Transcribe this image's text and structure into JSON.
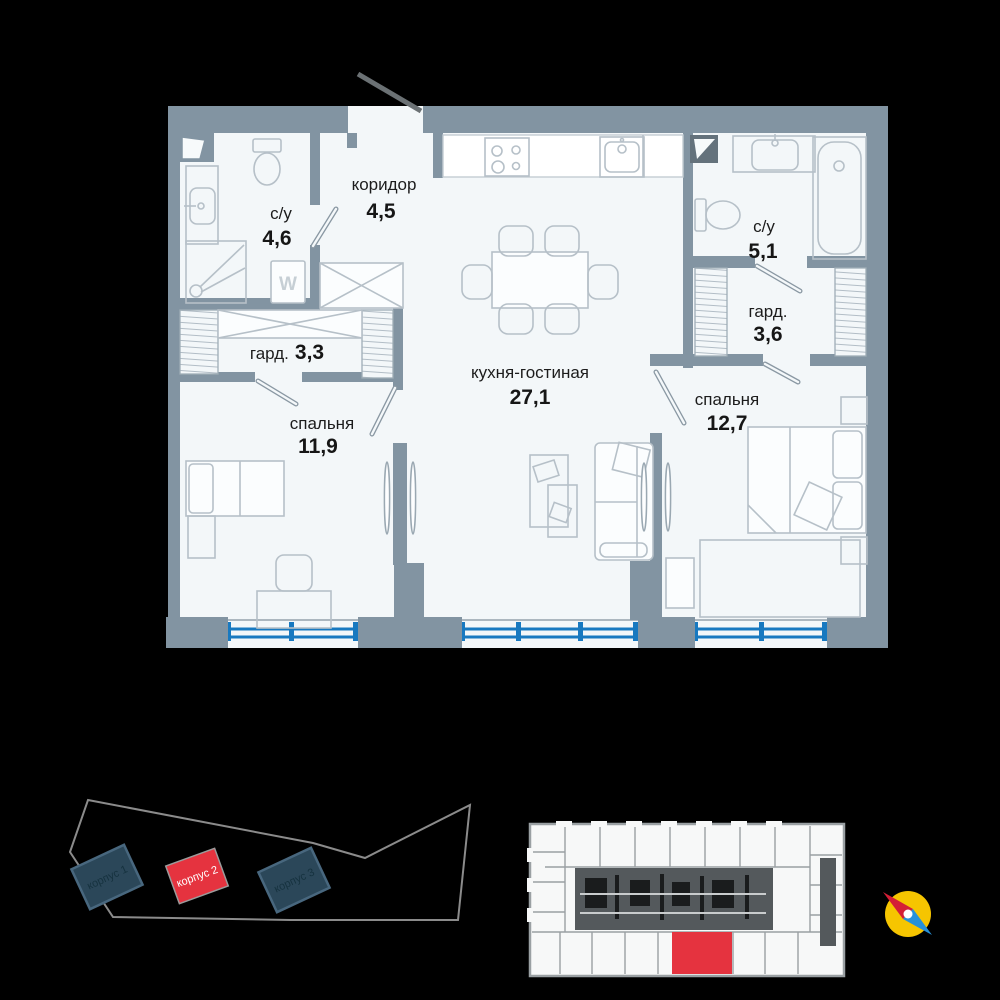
{
  "floor_plan": {
    "rooms": {
      "bathroom1": {
        "name": "с/у",
        "area": "4,6"
      },
      "corridor": {
        "name": "коридор",
        "area": "4,5"
      },
      "wardrobe1": {
        "name": "гард.",
        "area": "3,3"
      },
      "bedroom1": {
        "name": "спальня",
        "area": "11,9"
      },
      "kitchen_living": {
        "name": "кухня-гостиная",
        "area": "27,1"
      },
      "bathroom2": {
        "name": "с/у",
        "area": "5,1"
      },
      "wardrobe2": {
        "name": "гард.",
        "area": "3,6"
      },
      "bedroom2": {
        "name": "спальня",
        "area": "12,7"
      }
    },
    "washer_label": "W"
  },
  "site_plan": {
    "buildings": [
      {
        "label": "корпус 1",
        "highlighted": false
      },
      {
        "label": "корпус 2",
        "highlighted": true
      },
      {
        "label": "корпус 3",
        "highlighted": false
      }
    ]
  },
  "key_plan": {
    "selected_unit": "bottom-center",
    "selected_unit_color": "#e5333f"
  },
  "compass": {
    "north_color": "#d41f36",
    "south_color": "#2691d9",
    "dial_color": "#f6c500"
  },
  "colors": {
    "wall": "#8294a2",
    "room_fill": "#f3f7f9",
    "window_blue": "#1879c0",
    "highlight_red": "#e5333f",
    "building_dark": "#2b4759"
  }
}
